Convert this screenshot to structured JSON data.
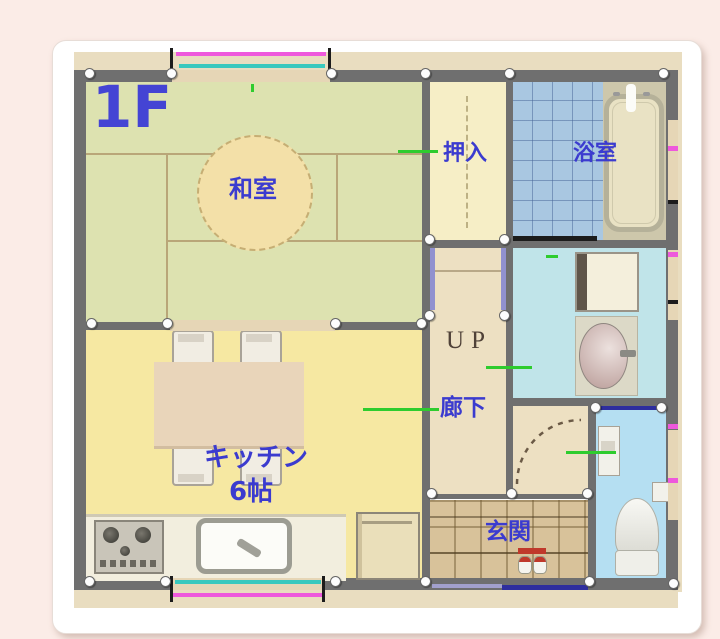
{
  "page": {
    "background_color": "#fbece7"
  },
  "floorplan_card": {
    "description": "first-floor plan image",
    "floor_label": "1F",
    "labels": {
      "washitsu": "和室",
      "oshiire": "押入",
      "bathroom": "浴室",
      "stairs_up": "UP",
      "hallway": "廊下",
      "kitchen": "キッチン",
      "kitchen_size": "6帖",
      "genkan": "玄関"
    },
    "palette": {
      "label_blue": "#3b3bcf",
      "up_text_brown": "#504238",
      "wall_gray": "#6f6f6f",
      "tatami_green": "#dde2b0",
      "closet_cream": "#f6eec6",
      "bath_tile_blue": "#a9c7e1",
      "washroom_cyan": "#c0e4e9",
      "toilet_blue": "#b5dff2",
      "corridor_tan": "#ede0c2",
      "genkan_tan": "#d8c29a",
      "kitchen_yellow": "#f6e8a2",
      "window_magenta": "#ee58dc",
      "window_cyan": "#39c8be",
      "entrance_door_navy": "#2e2e9e",
      "leader_green": "#2ecc2e",
      "page_pink": "#fbece7"
    }
  }
}
